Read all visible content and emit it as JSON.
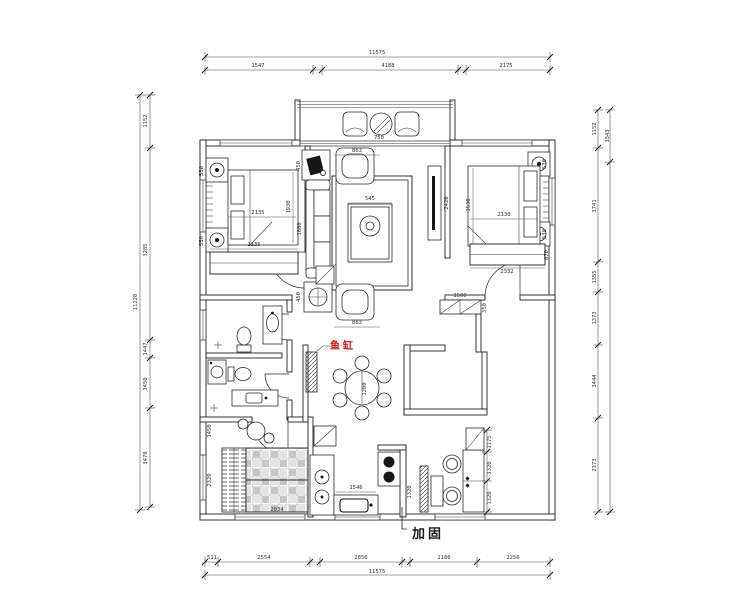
{
  "labels": {
    "fish_tank": "鱼缸",
    "reinforce": "加固"
  },
  "colors": {
    "line": "#2a2a2a",
    "red": "#cc1414",
    "plaid_dark": "#c6c6c6",
    "plaid_light": "#e3e3e3"
  },
  "dims": {
    "top": {
      "overall": "11575",
      "s": [
        "1547",
        "4188",
        "2175"
      ]
    },
    "bottom": {
      "overall": "11575",
      "s": [
        "511",
        "2554",
        "2856",
        "2180",
        "2256"
      ]
    },
    "left": {
      "overall": "11220",
      "s": [
        "1152",
        "3285",
        "1447",
        "1450",
        "3478"
      ]
    },
    "right": {
      "outer": "1343",
      "s": [
        "1152",
        "3741",
        "1355",
        "1373",
        "3444",
        "2173"
      ]
    },
    "plan": {
      "left_bed_w": "2135",
      "left_bed_l": "1930",
      "left_ns_top": "550",
      "left_ns_bot": "550",
      "left_wardrobe": "2135",
      "living_top": "863",
      "living_bot": "863",
      "sofa": "1800",
      "side_top": "450",
      "side_bot": "450",
      "coffee": "545",
      "tv": "2420",
      "balcony_table": "750",
      "right_bed_w": "2130",
      "right_bed_l": "1530",
      "right_ns_top": "530",
      "right_ns_bot": "530",
      "right_wardrobe": "2332",
      "right_wardrobe_d": "670",
      "dining": "1200",
      "shoe_w": "1500",
      "shoe_d": "350",
      "kitchen_w": "1546",
      "kitchen_d": "1320",
      "tatami_top": "1450",
      "tatami_side": "2320",
      "tatami_bot": "2034",
      "cab_1": "1175",
      "cab_2": "1320",
      "cab_3": "1320"
    }
  }
}
